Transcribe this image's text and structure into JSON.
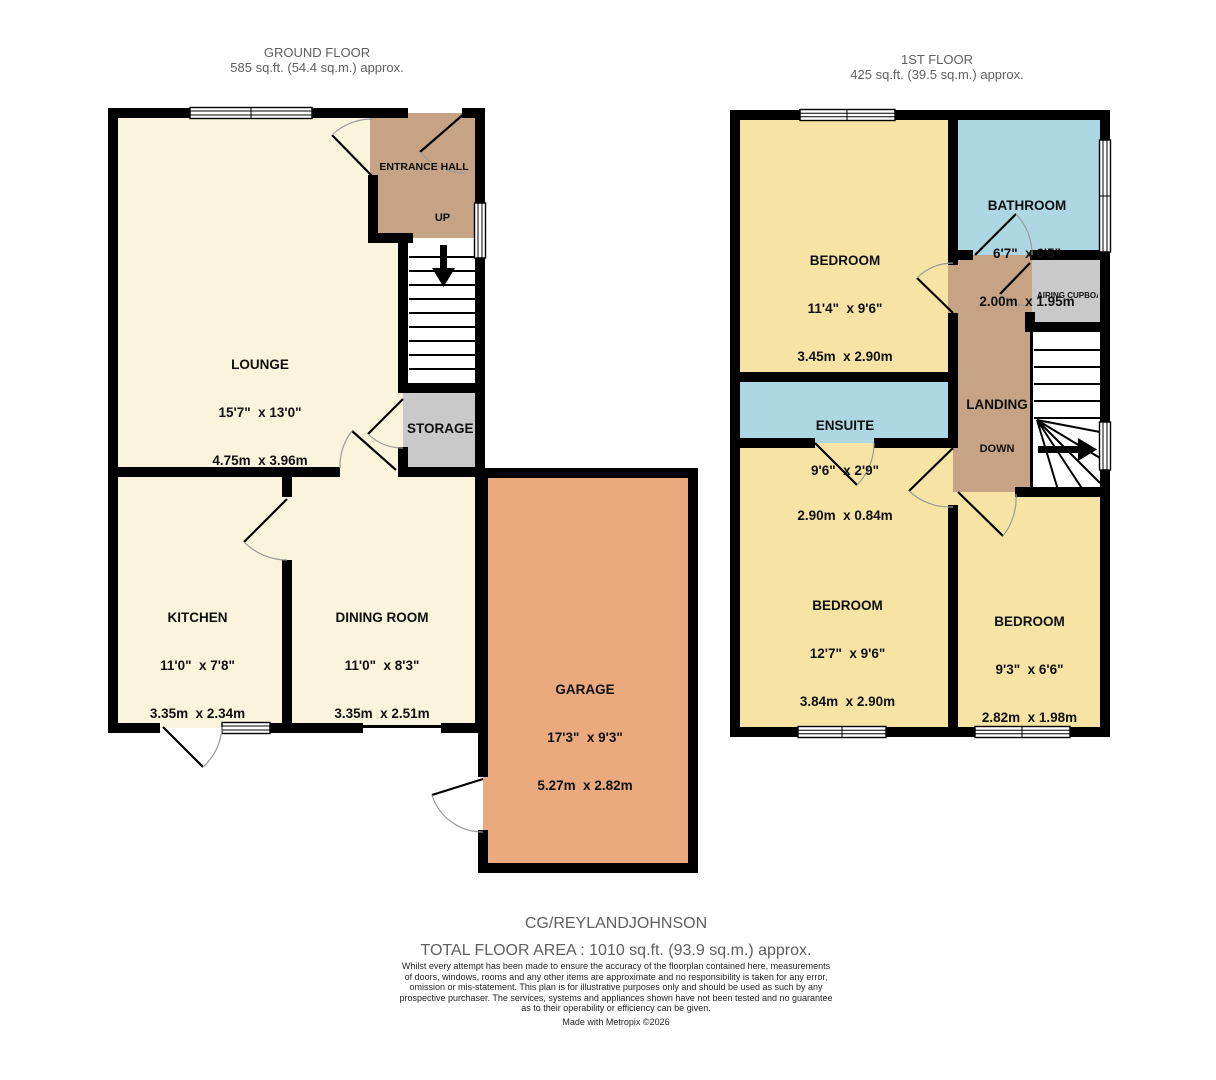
{
  "colors": {
    "cream": "#FAF4DC",
    "yellow": "#F7E4A5",
    "tan": "#C5A384",
    "blue": "#ADD8E3",
    "grey": "#C9C9C9",
    "orange": "#EAAA7D",
    "wall": "#000000",
    "muted": "#5f5f5f"
  },
  "ground_floor": {
    "title": "GROUND FLOOR",
    "subtitle": "585 sq.ft. (54.4 sq.m.) approx.",
    "rooms": {
      "lounge": {
        "name": "LOUNGE",
        "imperial": "15'7\"  x 13'0\"",
        "metric": "4.75m  x 3.96m"
      },
      "entrance_hall": {
        "name": "ENTRANCE HALL"
      },
      "stairs_up_label": "UP",
      "storage": {
        "name": "STORAGE"
      },
      "kitchen": {
        "name": "KITCHEN",
        "imperial": "11'0\"  x 7'8\"",
        "metric": "3.35m  x 2.34m"
      },
      "dining_room": {
        "name": "DINING ROOM",
        "imperial": "11'0\"  x 8'3\"",
        "metric": "3.35m  x 2.51m"
      },
      "garage": {
        "name": "GARAGE",
        "imperial": "17'3\"  x 9'3\"",
        "metric": "5.27m  x 2.82m"
      }
    }
  },
  "first_floor": {
    "title": "1ST FLOOR",
    "subtitle": "425 sq.ft. (39.5 sq.m.) approx.",
    "rooms": {
      "bedroom_1": {
        "name": "BEDROOM",
        "imperial": "11'4\"  x 9'6\"",
        "metric": "3.45m  x 2.90m"
      },
      "bathroom": {
        "name": "BATHROOM",
        "imperial": "6'7\"  x 6'5\"",
        "metric": "2.00m  x 1.95m"
      },
      "airing_cupboard": {
        "name": "AIRING CUPBOARD"
      },
      "ensuite": {
        "name": "ENSUITE",
        "imperial": "9'6\"  x 2'9\"",
        "metric": "2.90m  x 0.84m"
      },
      "landing": {
        "name": "LANDING"
      },
      "stairs_down_label": "DOWN",
      "bedroom_2": {
        "name": "BEDROOM",
        "imperial": "12'7\"  x 9'6\"",
        "metric": "3.84m  x 2.90m"
      },
      "bedroom_3": {
        "name": "BEDROOM",
        "imperial": "9'3\"  x 6'6\"",
        "metric": "2.82m  x 1.98m"
      }
    }
  },
  "footer": {
    "reference": "CG/REYLANDJOHNSON",
    "total_area": "TOTAL FLOOR AREA : 1010 sq.ft. (93.9 sq.m.) approx.",
    "disclaimer_lines": [
      "Whilst every attempt has been made to ensure the accuracy of the floorplan contained here, measurements",
      "of doors, windows, rooms and any other items are approximate and no responsibility is taken for any error,",
      "omission or mis-statement. This plan is for illustrative purposes only and should be used as such by any",
      "prospective purchaser. The services, systems and appliances shown have not been tested and no guarantee",
      "as to their operability or efficiency can be given.",
      "Made with Metropix ©2026"
    ]
  }
}
